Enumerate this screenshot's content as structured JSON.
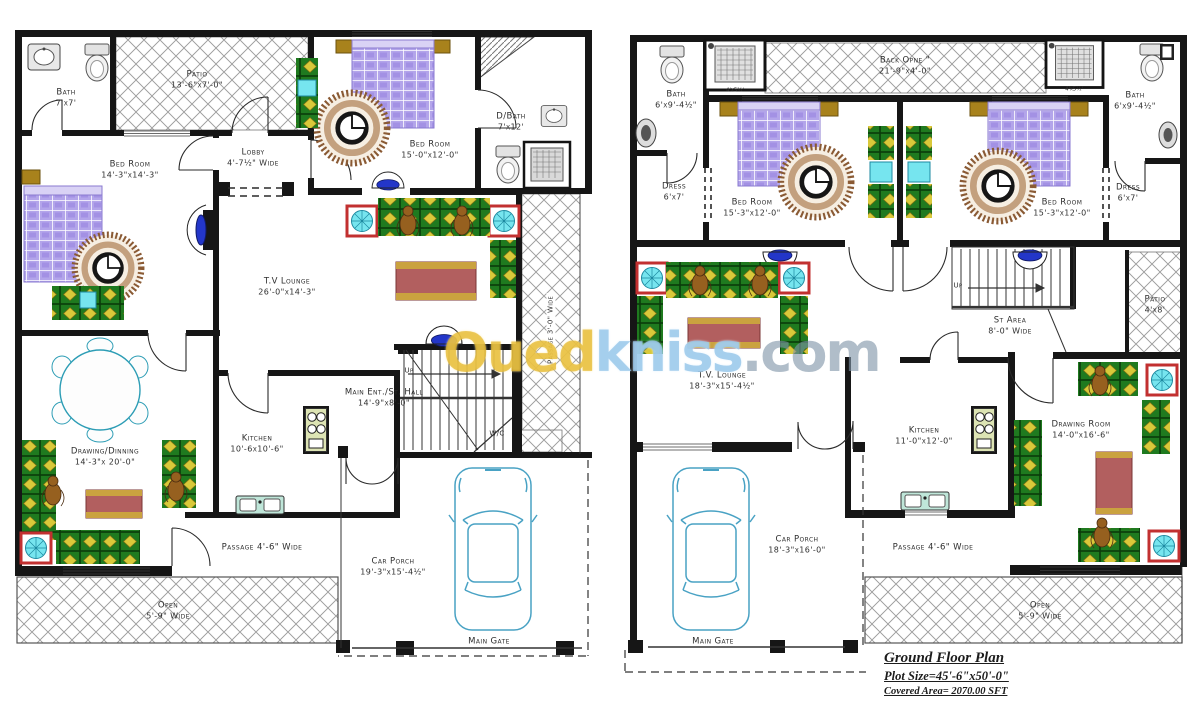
{
  "watermark": {
    "oued": "Oued",
    "kniss": "kniss",
    "com": ".com"
  },
  "title_block": {
    "title": "Ground Floor Plan",
    "plot_size": "Plot Size=45'-6\"x50'-0\"",
    "covered_area": "Covered Area= 2070.00 SFT"
  },
  "left_plan": {
    "bath": {
      "name": "Bath",
      "dims": "7'x7'"
    },
    "patio": {
      "name": "Patio",
      "dims": "13'-6\"x7'-0\""
    },
    "bedroom1": {
      "name": "Bed Room",
      "dims": "14'-3\"x14'-3\""
    },
    "lobby": {
      "name": "Lobby",
      "dims": "4'-7½\" Wide"
    },
    "bedroom2": {
      "name": "Bed Room",
      "dims": "15'-0\"x12'-0\""
    },
    "dbath": {
      "name": "D/Bath",
      "dims": "7'x12'"
    },
    "tv_lounge": {
      "name": "T.V Lounge",
      "dims": "26'-0\"x14'-3\""
    },
    "passage_side": {
      "name": "Passage 3'-0\" Wide"
    },
    "main_ent": {
      "name": "Main Ent./St. Hall",
      "dims": "14'-9\"x8'-0\""
    },
    "up": "Up",
    "wc": "W/C",
    "kitchen": {
      "name": "Kitchen",
      "dims": "10'-6x10'-6\""
    },
    "drawing": {
      "name": "Drawing/Dinning",
      "dims": "14'-3\"x 20'-0\""
    },
    "passage": {
      "name": "Passage 4'-6\" Wide"
    },
    "open": {
      "name": "Open",
      "dims": "5'-9\" Wide"
    },
    "car_porch": {
      "name": "Car Porch",
      "dims": "19'-3\"x15'-4½\""
    },
    "main_gate": "Main Gate"
  },
  "right_plan": {
    "bath_left": {
      "name": "Bath",
      "dims": "6'x9'-4½\""
    },
    "shower_left_label": "4'x5½'",
    "back_open": {
      "name": "Back Opne \"",
      "dims": "21'-9\"x4'-0\""
    },
    "shower_right_label": "4'x5½'",
    "bath_right": {
      "name": "Bath",
      "dims": "6'x9'-4½\""
    },
    "dress_left": {
      "name": "Dress",
      "dims": "6'x7'"
    },
    "bedroom_left": {
      "name": "Bed Room",
      "dims": "15'-3\"x12'-0\""
    },
    "bedroom_right": {
      "name": "Bed Room",
      "dims": "15'-3\"x12'-0\""
    },
    "dress_right": {
      "name": "Dress",
      "dims": "6'x7'"
    },
    "up": "Up",
    "st_area": {
      "name": "St Area",
      "dims": "8'-0\" Wide"
    },
    "patio": {
      "name": "Patio",
      "dims": "4'x8'"
    },
    "tv_lounge": {
      "name": "T.V. Lounge",
      "dims": "18'-3\"x15'-4½\""
    },
    "kitchen": {
      "name": "Kitchen",
      "dims": "11'-0\"x12'-0\""
    },
    "drawing_room": {
      "name": "Drawing Room",
      "dims": "14'-0\"x16'-6\""
    },
    "car_porch": {
      "name": "Car Porch",
      "dims": "18'-3\"x16'-0\""
    },
    "passage": {
      "name": "Passage 4'-6\" Wide"
    },
    "open": {
      "name": "Open",
      "dims": "5'-9\" Wide"
    },
    "main_gate": "Main Gate"
  }
}
